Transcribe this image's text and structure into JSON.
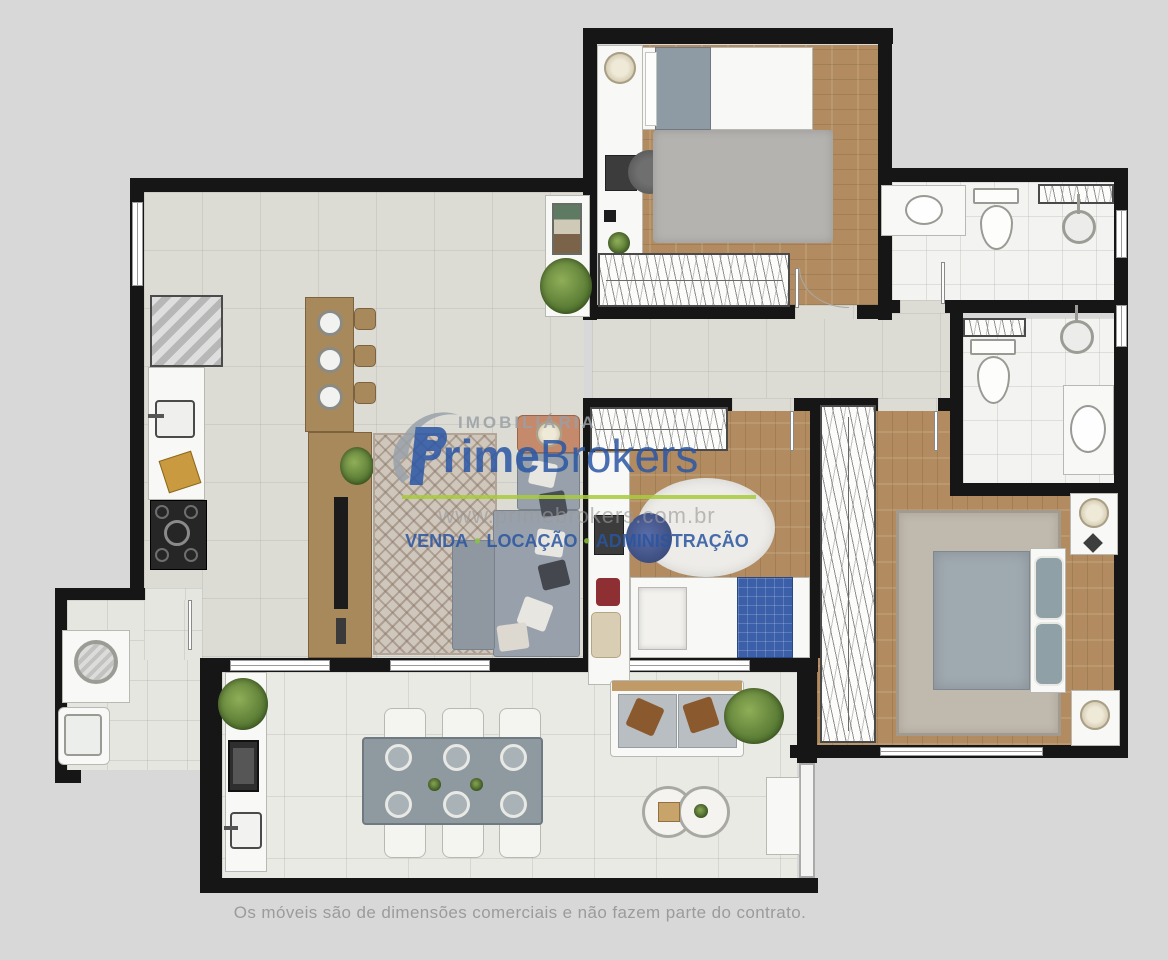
{
  "watermark": {
    "agency_type": "IMOBILIÁRIA",
    "brand_prime": "Prime",
    "brand_brokers": "Brokers",
    "website": "www.primebrokers.com.br",
    "service_venda": "VENDA",
    "service_locacao": "LOCAÇÃO",
    "service_administracao": "ADMINISTRAÇÃO",
    "bullet": "•",
    "colors": {
      "brand_blue": "#2b57a5",
      "accent_green": "#a9cc3d",
      "muted_gray": "#9aa0a6"
    }
  },
  "disclaimer": "Os móveis são de dimensões comerciais e não fazem parte do contrato.",
  "palette": {
    "background": "#d8d8d8",
    "wall": "#161616",
    "wood_floor": "#b28c60",
    "tile_floor": "#dcdcd4",
    "bath_floor": "#f3f3f1",
    "balcony_floor": "#eaeae5",
    "rug_gray": "#b5b3b0",
    "sofa_gray": "#98a1ab",
    "blanket_blue": "#3b5fa8"
  },
  "furniture_icons": [
    "fridge-icon",
    "kitchen-sink-icon",
    "stove-icon",
    "island-counter-icon",
    "stool-icon",
    "plate-icon",
    "tv-console-icon",
    "tv-icon",
    "sofa-icon",
    "side-table-lamp-icon",
    "pattern-rug-icon",
    "bed-double-icon",
    "bed-single-icon",
    "wardrobe-icon",
    "desk-icon",
    "desk-chair-icon",
    "round-rug-icon",
    "toilet-icon",
    "shower-head-icon",
    "vanity-sink-icon",
    "towel-rack-icon",
    "washer-icon",
    "laundry-tank-icon",
    "grill-icon",
    "bbq-sink-icon",
    "dining-table-icon",
    "chair-icon",
    "outdoor-sofa-icon",
    "coffee-table-icon",
    "ac-unit-icon",
    "plant-icon",
    "nightstand-icon",
    "lamp-icon",
    "console-table-icon"
  ]
}
